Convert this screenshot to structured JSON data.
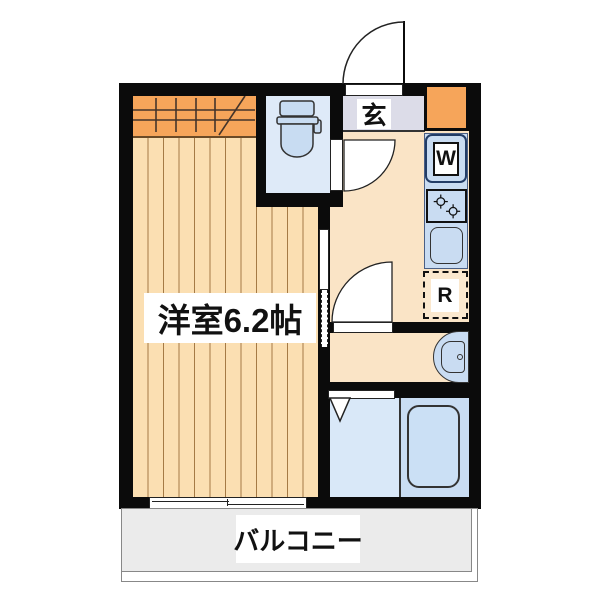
{
  "type": "apartment-floor-plan",
  "labels": {
    "main_room": "洋室6.2帖",
    "entrance": "玄",
    "balcony": "バルコニー",
    "washing_machine": "W",
    "refrigerator": "R"
  },
  "rooms": [
    {
      "name": "western-room",
      "label": "洋室6.2帖",
      "features": [
        "closet",
        "sliding-door",
        "balcony-window"
      ]
    },
    {
      "name": "entrance-hall",
      "label": "玄"
    },
    {
      "name": "kitchen-hallway",
      "features": [
        "washing-machine-space",
        "stove",
        "sink",
        "refrigerator-space"
      ]
    },
    {
      "name": "toilet-room",
      "features": [
        "toilet"
      ]
    },
    {
      "name": "washroom",
      "features": [
        "washbasin"
      ]
    },
    {
      "name": "bathroom",
      "features": [
        "bathtub",
        "folding-door"
      ]
    },
    {
      "name": "balcony",
      "label": "バルコニー"
    }
  ],
  "colors": {
    "wall": "#0B0B0B",
    "room_floor": "#FBDFB2",
    "room_floor_line": "#A57A45",
    "closet_orange": "#F6A55A",
    "hall_floor": "#FAE4C6",
    "entrance_floor": "#DCDCE8",
    "toilet_floor": "#DEEAF8",
    "fixture_blue": "#C9DCF2",
    "bathroom_floor": "#D9E8F8",
    "bathtub_zone": "#C9DDF3",
    "refrigerator_fill": "#FBE8CE",
    "balcony_fill": "#EBEBEB"
  }
}
